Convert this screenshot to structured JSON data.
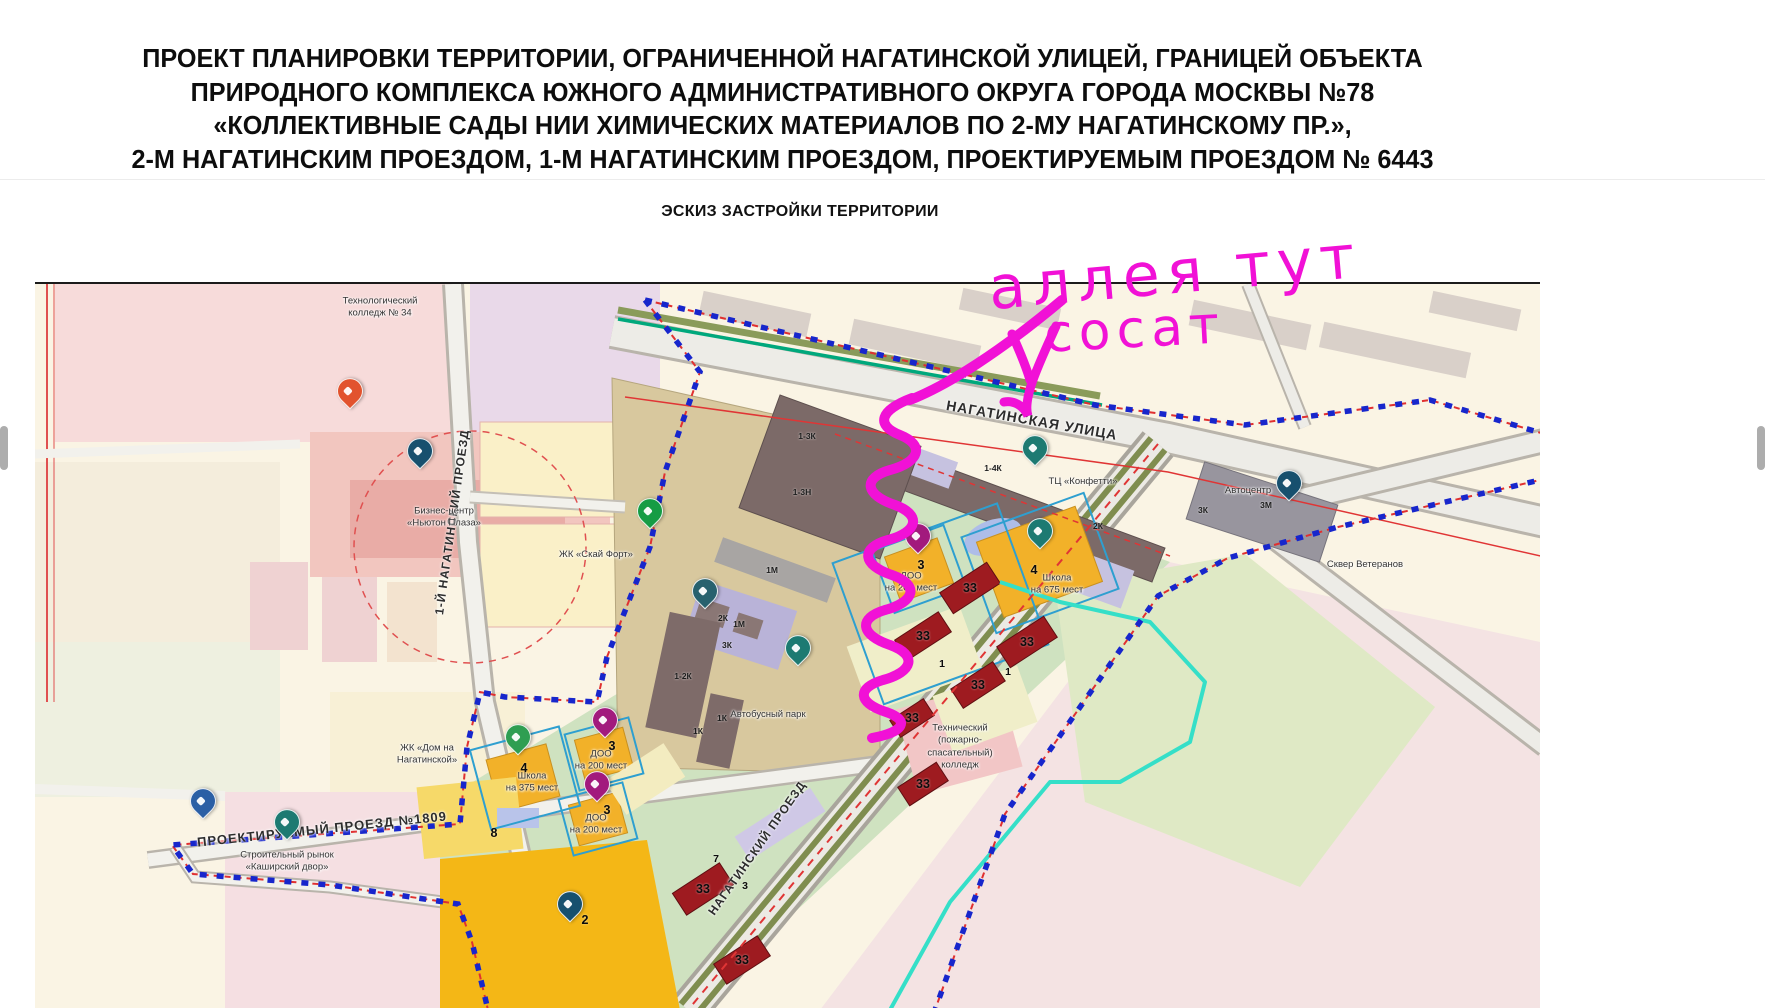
{
  "title": {
    "line1": "ПРОЕКТ ПЛАНИРОВКИ ТЕРРИТОРИИ, ОГРАНИЧЕННОЙ НАГАТИНСКОЙ УЛИЦЕЙ, ГРАНИЦЕЙ ОБЪЕКТА",
    "line2": "ПРИРОДНОГО КОМПЛЕКСА ЮЖНОГО АДМИНИСТРАТИВНОГО ОКРУГА ГОРОДА МОСКВЫ №78",
    "line3": "«КОЛЛЕКТИВНЫЕ САДЫ НИИ ХИМИЧЕСКИХ МАТЕРИАЛОВ ПО 2-МУ НАГАТИНСКОМУ ПР.»,",
    "line4": "2-М НАГАТИНСКИМ ПРОЕЗДОМ, 1-М НАГАТИНСКИМ ПРОЕЗДОМ, ПРОЕКТИРУЕМЫМ ПРОЕЗДОМ № 6443"
  },
  "subtitle": "ЭСКИЗ ЗАСТРОЙКИ ТЕРРИТОРИИ",
  "annotation": {
    "line1": "аллея тут",
    "line2": "сосат"
  },
  "map": {
    "street_labels": [
      {
        "name": "street-nagatinskaya-ulitsa",
        "text": "НАГАТИНСКАЯ УЛИЦА",
        "x": 997,
        "y": 136,
        "rot": 10,
        "size": 14
      },
      {
        "name": "street-1st-nagatinsky-proezd",
        "text": "1-Й НАГАТИНСКИЙ ПРОЕЗД",
        "x": 417,
        "y": 238,
        "rot": -82,
        "size": 12
      },
      {
        "name": "street-proektiruemy-proezd-1809",
        "text": "ПРОЕКТИРУЕМЫЙ  ПРОЕЗД №1809",
        "x": 287,
        "y": 545,
        "rot": -6,
        "size": 13
      },
      {
        "name": "street-nagatinsky-proezd",
        "text": "НАГАТИНСКИЙ ПРОЕЗД",
        "x": 722,
        "y": 564,
        "rot": -55,
        "size": 12
      }
    ],
    "place_labels": [
      {
        "name": "label-tech-college-34",
        "text": "Технологический\nколледж № 34",
        "x": 345,
        "y": 24
      },
      {
        "name": "label-business-center",
        "text": "Бизнес-центр\n«Ньютон Плаза»",
        "x": 409,
        "y": 234
      },
      {
        "name": "label-zhk-sky-fort",
        "text": "ЖК «Скай Форт»",
        "x": 561,
        "y": 271
      },
      {
        "name": "label-zhk-dom-na-nagatinskoy",
        "text": "ЖК «Дом на\nНагатинской»",
        "x": 392,
        "y": 471
      },
      {
        "name": "label-kashirsky-dvor",
        "text": "Строительный рынок\n«Каширский двор»",
        "x": 252,
        "y": 578
      },
      {
        "name": "label-bus-park",
        "text": "Автобусный парк",
        "x": 733,
        "y": 431
      },
      {
        "name": "label-tc-konfetti",
        "text": "ТЦ «Конфетти»",
        "x": 1048,
        "y": 198
      },
      {
        "name": "label-autocenter",
        "text": "Автоцентр",
        "x": 1213,
        "y": 207
      },
      {
        "name": "label-skver-veteranov",
        "text": "Сквер Ветеранов",
        "x": 1330,
        "y": 281
      },
      {
        "name": "label-tech-fire-college",
        "text": "Технический\n(пожарно-\nспасательный)\nколледж",
        "x": 925,
        "y": 463
      },
      {
        "name": "label-school-675",
        "text": "Школа\nна 675 мест",
        "x": 1022,
        "y": 301
      },
      {
        "name": "label-doo-200-a",
        "text": "ДОО\nна 200 мест",
        "x": 876,
        "y": 299
      },
      {
        "name": "label-school-375",
        "text": "Школа\nна 375 мест",
        "x": 497,
        "y": 499
      },
      {
        "name": "label-doo-200-b",
        "text": "ДОО\nна 200 мест",
        "x": 566,
        "y": 477
      },
      {
        "name": "label-doo-200-c",
        "text": "ДОО\nна 200 мест",
        "x": 561,
        "y": 541
      }
    ],
    "building_codes": [
      {
        "text": "1-3К",
        "x": 772,
        "y": 152
      },
      {
        "text": "1-3Н",
        "x": 767,
        "y": 208
      },
      {
        "text": "1М",
        "x": 737,
        "y": 286
      },
      {
        "text": "2К",
        "x": 688,
        "y": 334
      },
      {
        "text": "1М",
        "x": 704,
        "y": 340
      },
      {
        "text": "3К",
        "x": 692,
        "y": 361
      },
      {
        "text": "1-2К",
        "x": 648,
        "y": 392
      },
      {
        "text": "1К",
        "x": 687,
        "y": 434
      },
      {
        "text": "1К",
        "x": 663,
        "y": 447
      },
      {
        "text": "1-4К",
        "x": 958,
        "y": 184
      },
      {
        "text": "3М",
        "x": 1231,
        "y": 221
      },
      {
        "text": "3К",
        "x": 1168,
        "y": 226
      },
      {
        "text": "2К",
        "x": 1063,
        "y": 242
      }
    ],
    "plot_numbers": [
      {
        "text": "33",
        "x": 935,
        "y": 304,
        "cls": ""
      },
      {
        "text": "33",
        "x": 888,
        "y": 352,
        "cls": ""
      },
      {
        "text": "33",
        "x": 992,
        "y": 358,
        "cls": ""
      },
      {
        "text": "33",
        "x": 943,
        "y": 401,
        "cls": ""
      },
      {
        "text": "33",
        "x": 877,
        "y": 434,
        "cls": ""
      },
      {
        "text": "33",
        "x": 888,
        "y": 500,
        "cls": ""
      },
      {
        "text": "33",
        "x": 668,
        "y": 605,
        "cls": ""
      },
      {
        "text": "33",
        "x": 707,
        "y": 676,
        "cls": ""
      },
      {
        "text": "1",
        "x": 907,
        "y": 380,
        "cls": "sm"
      },
      {
        "text": "1",
        "x": 973,
        "y": 388,
        "cls": "sm"
      },
      {
        "text": "4",
        "x": 999,
        "y": 286,
        "cls": ""
      },
      {
        "text": "4",
        "x": 489,
        "y": 484,
        "cls": ""
      },
      {
        "text": "3",
        "x": 886,
        "y": 281,
        "cls": ""
      },
      {
        "text": "3",
        "x": 577,
        "y": 462,
        "cls": ""
      },
      {
        "text": "3",
        "x": 572,
        "y": 526,
        "cls": ""
      },
      {
        "text": "3",
        "x": 710,
        "y": 602,
        "cls": "sm"
      },
      {
        "text": "7",
        "x": 681,
        "y": 575,
        "cls": "sm"
      },
      {
        "text": "2",
        "x": 550,
        "y": 636,
        "cls": ""
      },
      {
        "text": "8",
        "x": 459,
        "y": 549,
        "cls": ""
      }
    ],
    "pins": [
      {
        "name": "business-center-pin",
        "x": 385,
        "y": 178,
        "color": "#17506e"
      },
      {
        "name": "college-logo-pin",
        "x": 315,
        "y": 118,
        "color": "#e2532e"
      },
      {
        "name": "pharmacy-pin",
        "x": 615,
        "y": 238,
        "color": "#169c44"
      },
      {
        "name": "factory-pin",
        "x": 670,
        "y": 318,
        "color": "#27616e"
      },
      {
        "name": "bus-park-pin",
        "x": 763,
        "y": 375,
        "color": "#1d7a72"
      },
      {
        "name": "shopping-cart-pin",
        "x": 1000,
        "y": 175,
        "color": "#1d7a72"
      },
      {
        "name": "car-center-pin",
        "x": 1254,
        "y": 210,
        "color": "#17506e"
      },
      {
        "name": "doo-children-pin",
        "x": 883,
        "y": 263,
        "color": "#a21a7d"
      },
      {
        "name": "school-675-pin",
        "x": 1005,
        "y": 258,
        "color": "#1d7a72"
      },
      {
        "name": "school-375-pin",
        "x": 483,
        "y": 464,
        "color": "#2f9e52"
      },
      {
        "name": "doo-a-pin",
        "x": 570,
        "y": 447,
        "color": "#a21a7d"
      },
      {
        "name": "doo-b-pin",
        "x": 562,
        "y": 511,
        "color": "#a21a7d"
      },
      {
        "name": "plot-2-pin",
        "x": 535,
        "y": 631,
        "color": "#17506e"
      },
      {
        "name": "market-pin",
        "x": 252,
        "y": 549,
        "color": "#1d7a72"
      },
      {
        "name": "transport-pin",
        "x": 168,
        "y": 528,
        "color": "#2b5fa5"
      }
    ]
  },
  "colors": {
    "annotation_magenta": "#f111d6",
    "boundary_blue": "#1726cc",
    "boundary_red": "#e03030",
    "school_yellow": "#f2b129",
    "building_red": "#9e1b20",
    "park_green": "#cfe2c0",
    "buspark_tan": "#d8c89e",
    "teal_line": "#00a87c",
    "cyan_line": "#35dfc8"
  }
}
